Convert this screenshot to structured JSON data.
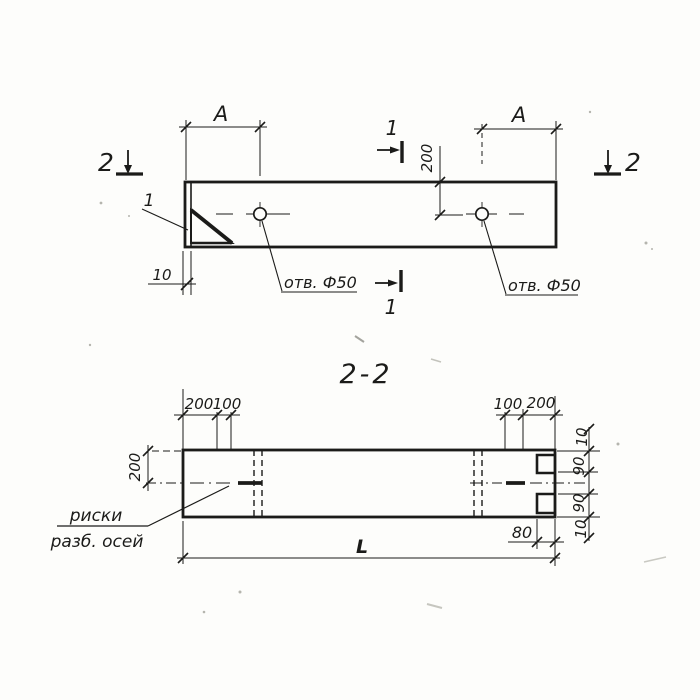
{
  "plan_view": {
    "dim_a": "A",
    "section_mark_1": "1",
    "section_mark_2": "2",
    "dim_200": "200",
    "dim_10": "10",
    "gusset_detail_label": "1",
    "hole_note": "отв. Ф50"
  },
  "section_view": {
    "title": "2-2",
    "dim_height_200": "200",
    "top_dims_left": [
      "200",
      "100"
    ],
    "top_dims_right": [
      "100",
      "200"
    ],
    "right_dims": [
      "10",
      "90",
      "90",
      "10"
    ],
    "dim_80": "80",
    "dim_length": "L",
    "axis_note_line1": "риски",
    "axis_note_line2": "разб. осей"
  },
  "colors": {
    "ink": "#1b1b19",
    "paper": "#fdfdfb"
  }
}
